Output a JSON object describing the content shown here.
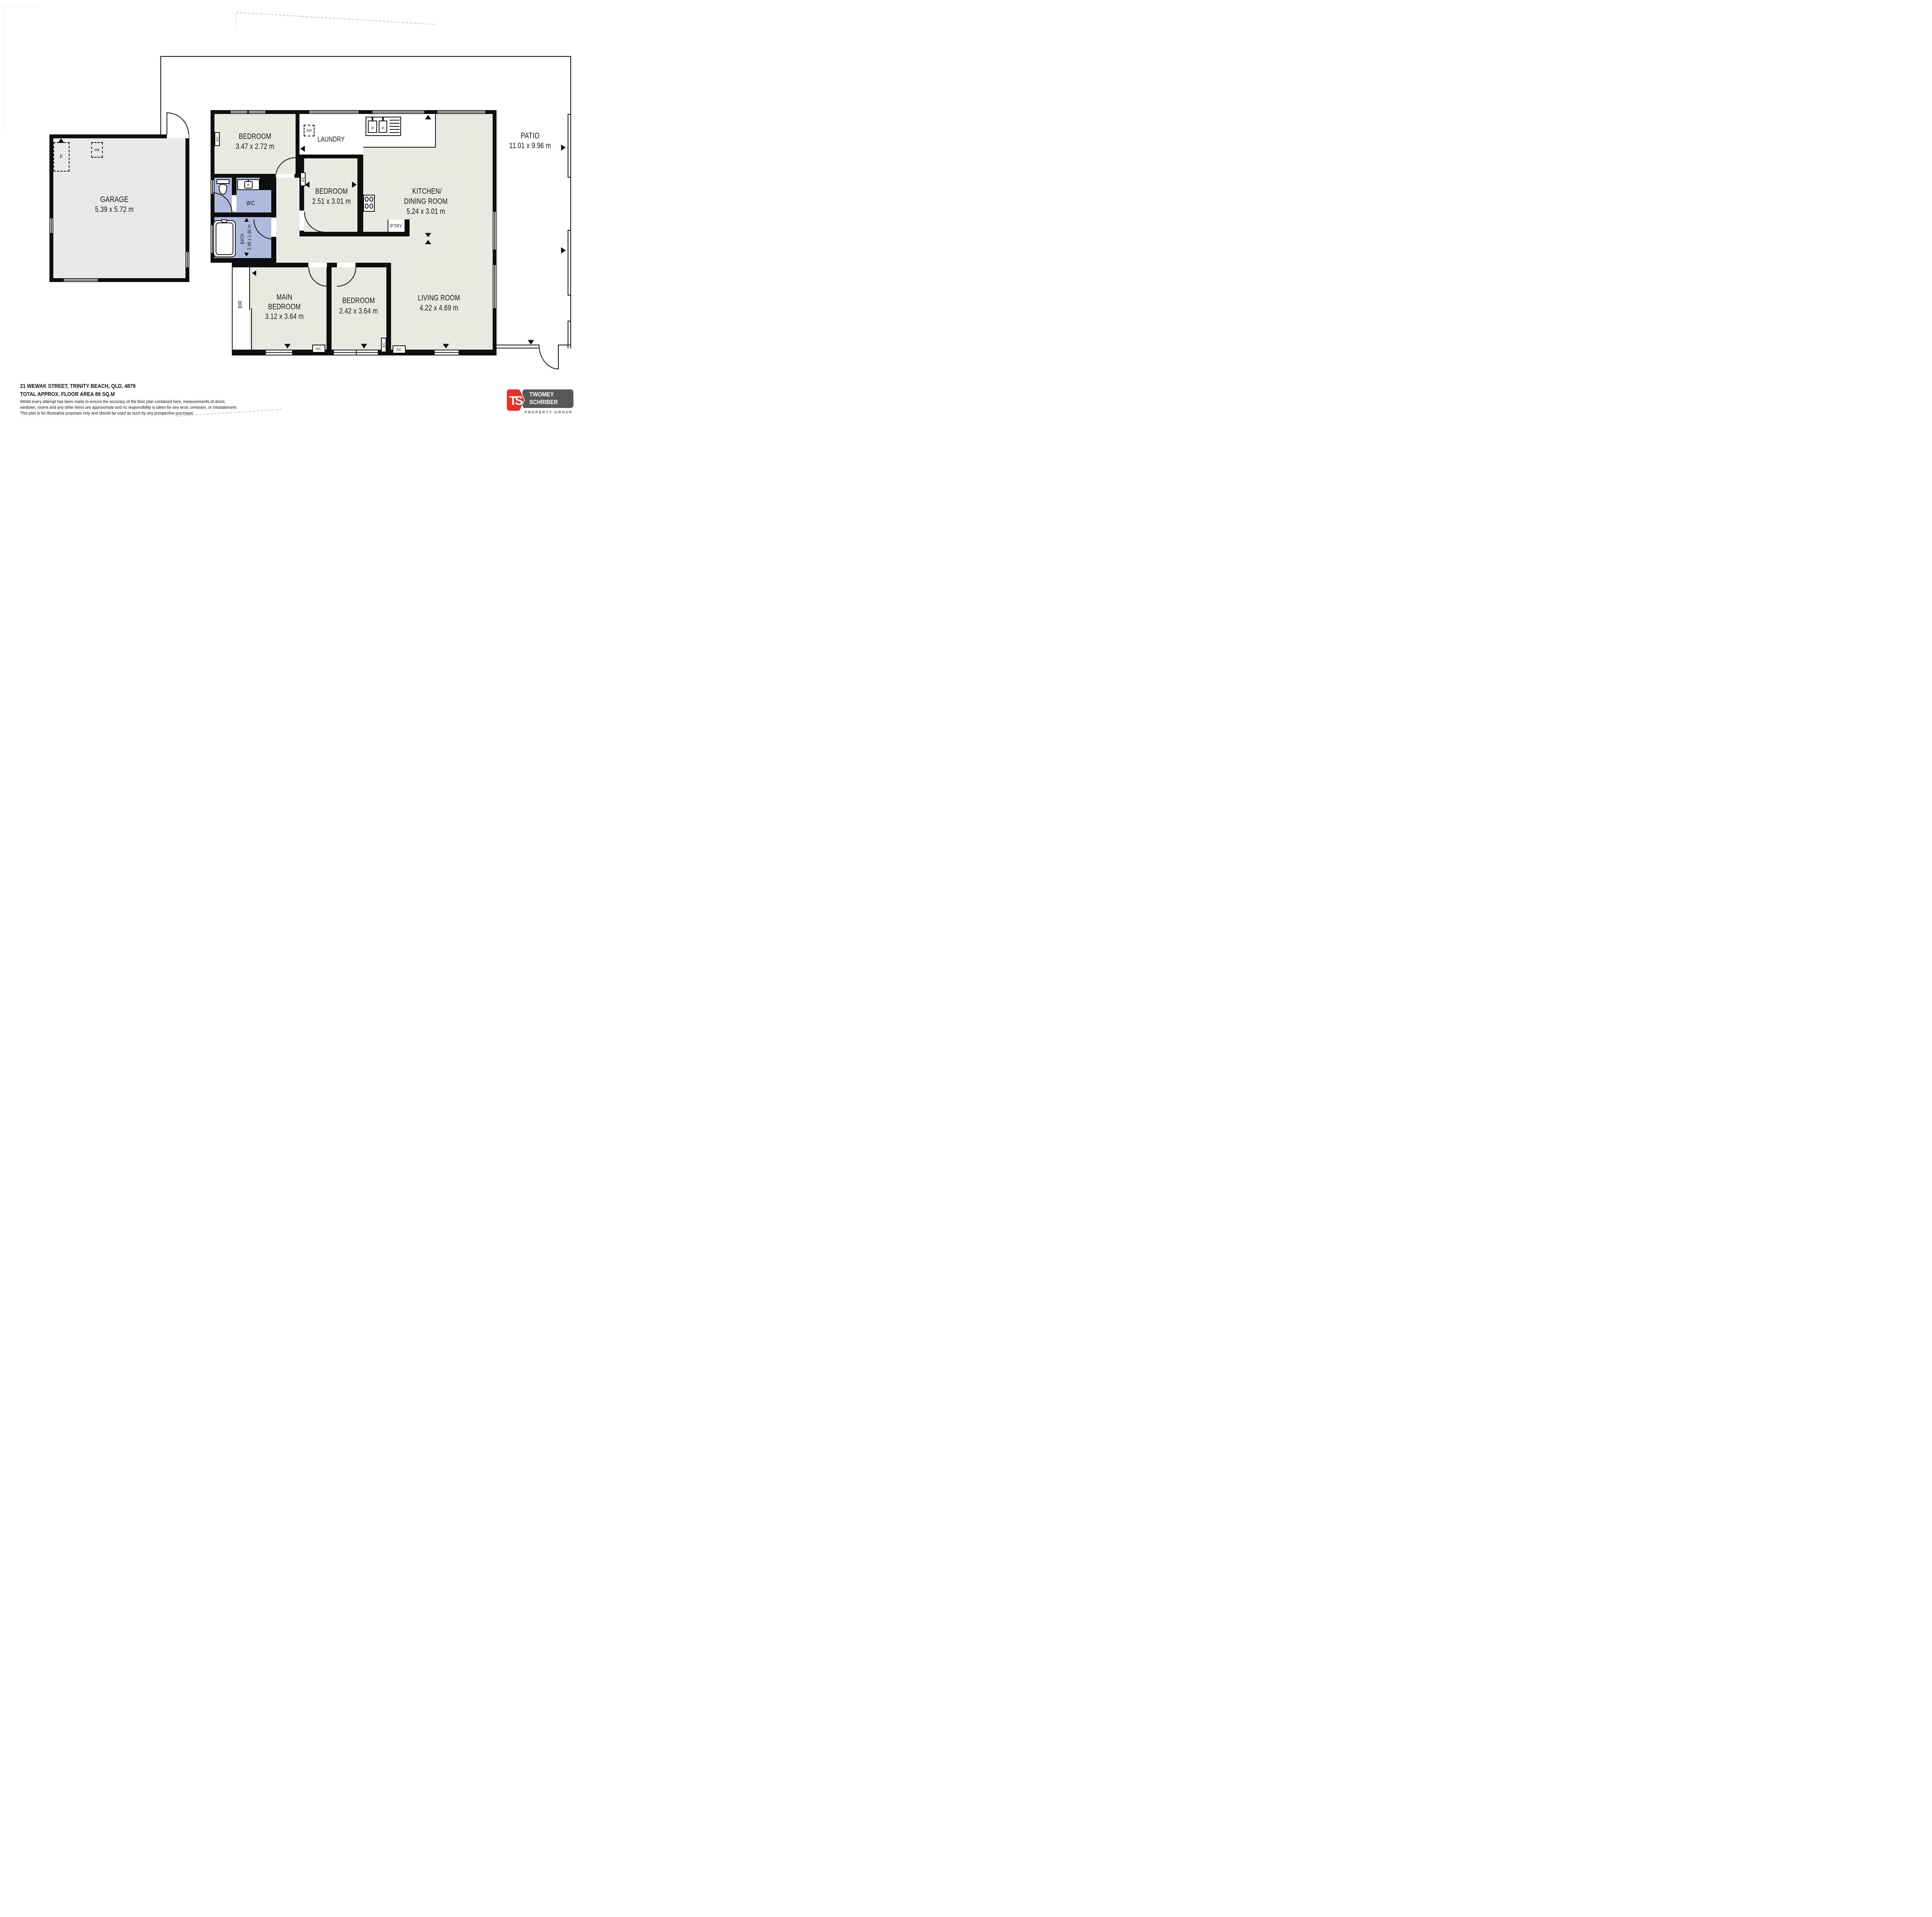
{
  "plan": {
    "rooms": {
      "garage": {
        "name": "GARAGE",
        "dims": "5.39 x 5.72 m"
      },
      "bedroom_top": {
        "name": "BEDROOM",
        "dims": "3.47 x 2.72 m"
      },
      "laundry": {
        "name": "LAUNDRY"
      },
      "patio": {
        "name": "PATIO",
        "dims": "11.01 x 9.96 m"
      },
      "bedroom_mid": {
        "name": "BEDROOM",
        "dims": "2.51 x 3.01 m"
      },
      "kitchen": {
        "name_line1": "KITCHEN/",
        "name_line2": "DINING ROOM",
        "dims": "5.24 x 3.01 m"
      },
      "pantry": {
        "name": "P'TRY"
      },
      "wc": {
        "name": "WC"
      },
      "bath": {
        "name": "BATH",
        "dims": "2.46 x 1.60 m"
      },
      "bir": {
        "name": "BIR"
      },
      "main_bedroom": {
        "name_line1": "MAIN",
        "name_line2": "BEDROOM",
        "dims": "3.12 x 3.64 m"
      },
      "bedroom_bottom": {
        "name": "BEDROOM",
        "dims": "2.42 x 3.64 m"
      },
      "living": {
        "name": "LIVING ROOM",
        "dims": "4.22 x 4.69 m"
      }
    },
    "fixtures": {
      "ac": "A/C",
      "wm": "WM",
      "fridge": "F"
    }
  },
  "footer": {
    "address": "21 WEWAK STREET, TRINITY BEACH, QLD, 4879",
    "area": "TOTAL APPROX. FLOOR AREA 89 SQ.M",
    "disclaimer_line1": "Whilst every attempt has been made to ensure the accuracy of the floor plan contained here, measurements of doors,",
    "disclaimer_line2": "windows, rooms and any other items are approximate and no responsibility is taken for any error, omission, or misstatement.",
    "disclaimer_line3": "This plan is for illustrative purposes only and should be used as such by any prospective purchaser."
  },
  "logo": {
    "monogram": "TS",
    "name_line1": "TWOMEY",
    "name_line2": "SCHRIBER",
    "tagline": "PROPERTY GROUP"
  },
  "colors": {
    "wall": "#0e0e0e",
    "room_fill": "#e8e9e1",
    "garage_fill": "#e9e9e8",
    "wet_fill": "#aebade",
    "faint": "#c9c9c9",
    "logo_red": "#e5332b",
    "logo_gray": "#57585a"
  }
}
